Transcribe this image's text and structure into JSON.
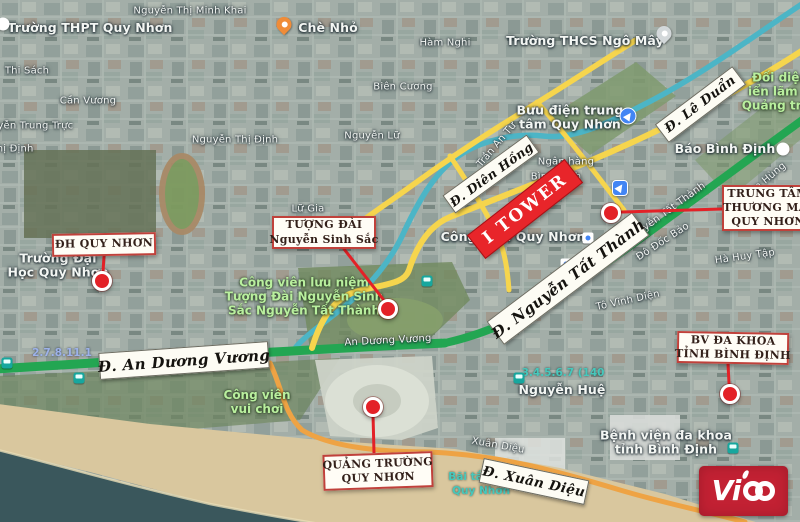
{
  "vico": {
    "brand": "Vico",
    "prefix": "Vi"
  },
  "colors": {
    "road_green": "#23a652",
    "road_yellow": "#f6d54d",
    "road_orange": "#eea344",
    "road_blue": "#4cb5c6",
    "marker_red": "#e32127",
    "callout_border": "#c0413b",
    "callout_text": "#33201a",
    "itower_bg": "#e8252a",
    "vico_bg": "#c22133",
    "sea": "#3a575c",
    "sand": "#d9c79e",
    "park_text": "#b9ef9e"
  },
  "map": {
    "street_labels": [
      {
        "t": "Nguyễn Thị Minh Khai",
        "x": 190,
        "y": 11
      },
      {
        "t": "Thi Sách",
        "x": 27,
        "y": 71
      },
      {
        "t": "Cần Vương",
        "x": 88,
        "y": 101
      },
      {
        "t": "Nguyễn Trung Trực",
        "x": 25,
        "y": 126
      },
      {
        "t": "Thị Định",
        "x": 12,
        "y": 149
      },
      {
        "t": "Nguyễn Thị Định",
        "x": 235,
        "y": 140
      },
      {
        "t": "Nguyễn Lữ",
        "x": 372,
        "y": 136
      },
      {
        "t": "Hàm Nghi",
        "x": 445,
        "y": 43
      },
      {
        "t": "Biên Cương",
        "x": 403,
        "y": 87
      },
      {
        "t": "Trần An Tư",
        "x": 497,
        "y": 145,
        "r": -50
      },
      {
        "t": "Tô Vĩnh Diện",
        "x": 628,
        "y": 301,
        "r": -12
      },
      {
        "t": "Đô Đốc Bảo",
        "x": 663,
        "y": 242,
        "r": -33
      },
      {
        "t": "Hà Huy Tập",
        "x": 745,
        "y": 257,
        "r": -8
      },
      {
        "t": "Phạm Hùng",
        "x": 762,
        "y": 184,
        "r": -40
      },
      {
        "t": "Xuân Diệu",
        "x": 498,
        "y": 446,
        "r": 10
      },
      {
        "t": "An Dương Vương",
        "x": 388,
        "y": 341,
        "r": -3
      },
      {
        "t": "Nguyễn Tất Thành",
        "x": 666,
        "y": 213,
        "r": -36
      },
      {
        "t": "Ngân hàng",
        "x": 566,
        "y": 162
      },
      {
        "t": "Bình Định",
        "x": 556,
        "y": 177
      },
      {
        "t": "Lữ Gia",
        "x": 308,
        "y": 209
      }
    ],
    "place_labels": [
      {
        "lines": [
          "Trường THPT Quy Nhơn"
        ],
        "x": 90,
        "y": 28
      },
      {
        "lines": [
          "Chè Nhỏ"
        ],
        "x": 328,
        "y": 28
      },
      {
        "lines": [
          "Trường THCS Ngô Mây"
        ],
        "x": 585,
        "y": 41
      },
      {
        "lines": [
          "Bưu điện trung",
          "tâm Quy Nhơn"
        ],
        "x": 570,
        "y": 118
      },
      {
        "lines": [
          "Báo Bình Định"
        ],
        "x": 725,
        "y": 149
      },
      {
        "lines": [
          "Trường Đại",
          "Học Quy Nhơn"
        ],
        "x": 58,
        "y": 266
      },
      {
        "lines": [
          "Công viên Quy Nhơn"
        ],
        "x": 513,
        "y": 237
      },
      {
        "lines": [
          "Nguyễn Huệ"
        ],
        "x": 562,
        "y": 390
      },
      {
        "lines": [
          "Bệnh viện đa khoa",
          "tỉnh Bình Định"
        ],
        "x": 666,
        "y": 443
      }
    ],
    "park_labels": [
      {
        "lines": [
          "Công viên lưu niệm",
          "Tượng Đài Nguyễn Sinh",
          "Sắc Nguyễn Tất Thành"
        ],
        "x": 304,
        "y": 297
      },
      {
        "lines": [
          "Công viên",
          "vui chơi"
        ],
        "x": 257,
        "y": 403
      },
      {
        "lines": [
          "Đối diện",
          "iển lãm Q",
          "Quảng trườ"
        ],
        "x": 780,
        "y": 92
      }
    ],
    "transit_labels": [
      {
        "t": "2.7.8.11.1",
        "x": 62,
        "y": 353,
        "c": "blue"
      },
      {
        "t": "3.4.5.6.7 (140",
        "x": 563,
        "y": 373,
        "c": "teal"
      },
      {
        "t": "Bãi tắm",
        "x": 471,
        "y": 477,
        "c": "teal"
      },
      {
        "t": "Quy Nhơn",
        "x": 481,
        "y": 491,
        "c": "teal"
      }
    ],
    "road_signs": [
      {
        "id": "an-duong-vuong",
        "t": "Đ. An Dương Vương",
        "x": 184,
        "y": 360,
        "w": 170,
        "h": 27,
        "r": -4,
        "fs": 15
      },
      {
        "id": "le-duan",
        "t": "Đ. Lê Duẩn",
        "x": 700,
        "y": 104,
        "w": 97,
        "h": 23,
        "r": -37,
        "fs": 13
      },
      {
        "id": "dien-hong",
        "t": "Đ. Diên Hồng",
        "x": 491,
        "y": 174,
        "w": 104,
        "h": 22,
        "r": -36,
        "fs": 12.5
      },
      {
        "id": "nguyen-tat-thanh",
        "t": "Đ. Nguyễn Tất Thành",
        "x": 568,
        "y": 278,
        "w": 182,
        "h": 29,
        "r": -37,
        "fs": 15
      },
      {
        "id": "xuan-dieu",
        "t": "Đ. Xuân Diệu",
        "x": 534,
        "y": 481,
        "w": 108,
        "h": 25,
        "r": 12,
        "fs": 13.5
      }
    ],
    "itower": {
      "t": "I TOWER",
      "x": 525,
      "y": 209,
      "w": 124,
      "h": 30,
      "r": -38
    },
    "callouts": [
      {
        "id": "dh-quy-nhon",
        "lines": [
          "ĐH QUY NHƠN"
        ],
        "x": 52,
        "y": 233,
        "w": 104,
        "h": 23,
        "r": -1,
        "marker": [
          102,
          281
        ],
        "line": [
          104,
          256,
          103,
          272
        ]
      },
      {
        "id": "tuong-dai-nguyen-sinh-sac",
        "lines": [
          "TƯỢNG ĐÀI",
          "Nguyễn Sinh Sắc"
        ],
        "x": 272,
        "y": 216,
        "w": 104,
        "h": 33,
        "r": 0,
        "marker": [
          388,
          309
        ],
        "line": [
          344,
          249,
          386,
          303
        ]
      },
      {
        "id": "trung-tam-thuong-mai-quy-nhon",
        "lines": [
          "TRUNG TÂM",
          "THƯƠNG MẠI",
          "QUY NHƠN"
        ],
        "x": 722,
        "y": 185,
        "w": 92,
        "h": 46,
        "r": 0,
        "marker": [
          611,
          213
        ],
        "line": [
          622,
          212,
          722,
          209
        ]
      },
      {
        "id": "bv-da-khoa-tinh-binh-dinh",
        "lines": [
          "BV ĐA KHOA",
          "TỈNH BÌNH ĐỊNH"
        ],
        "x": 677,
        "y": 332,
        "w": 112,
        "h": 32,
        "r": 1,
        "marker": [
          730,
          394
        ],
        "line": [
          728,
          364,
          729,
          383
        ]
      },
      {
        "id": "quang-truong-quy-nhon",
        "lines": [
          "QUẢNG TRƯỜNG",
          "QUY NHƠN"
        ],
        "x": 323,
        "y": 453,
        "w": 110,
        "h": 36,
        "r": -2,
        "marker": [
          373,
          407
        ],
        "line": [
          373,
          414,
          374,
          453
        ]
      }
    ],
    "icons": [
      {
        "type": "pin-orange",
        "name": "food-pin-icon",
        "x": 284,
        "y": 26
      },
      {
        "type": "pin-grey",
        "name": "poi-pin-icon",
        "x": 664,
        "y": 35
      },
      {
        "type": "dot-white",
        "name": "poi-dot-icon",
        "x": 783,
        "y": 149
      },
      {
        "type": "dot-white",
        "name": "poi-dot-icon",
        "x": 3,
        "y": 24
      },
      {
        "type": "nav-circle",
        "name": "direction-icon",
        "x": 628,
        "y": 116
      },
      {
        "type": "nav-square",
        "name": "navigation-icon",
        "x": 620,
        "y": 188
      },
      {
        "type": "bus",
        "name": "bus-stop-icon",
        "x": 7,
        "y": 363
      },
      {
        "type": "bus",
        "name": "bus-stop-icon",
        "x": 79,
        "y": 378
      },
      {
        "type": "bus",
        "name": "bus-stop-icon",
        "x": 519,
        "y": 378
      },
      {
        "type": "bus",
        "name": "bus-stop-icon",
        "x": 733,
        "y": 448
      },
      {
        "type": "bus",
        "name": "bus-stop-icon",
        "x": 427,
        "y": 281
      },
      {
        "type": "station",
        "name": "station-icon",
        "x": 588,
        "y": 238
      },
      {
        "type": "station",
        "name": "station-icon",
        "x": 566,
        "y": 264
      }
    ]
  }
}
